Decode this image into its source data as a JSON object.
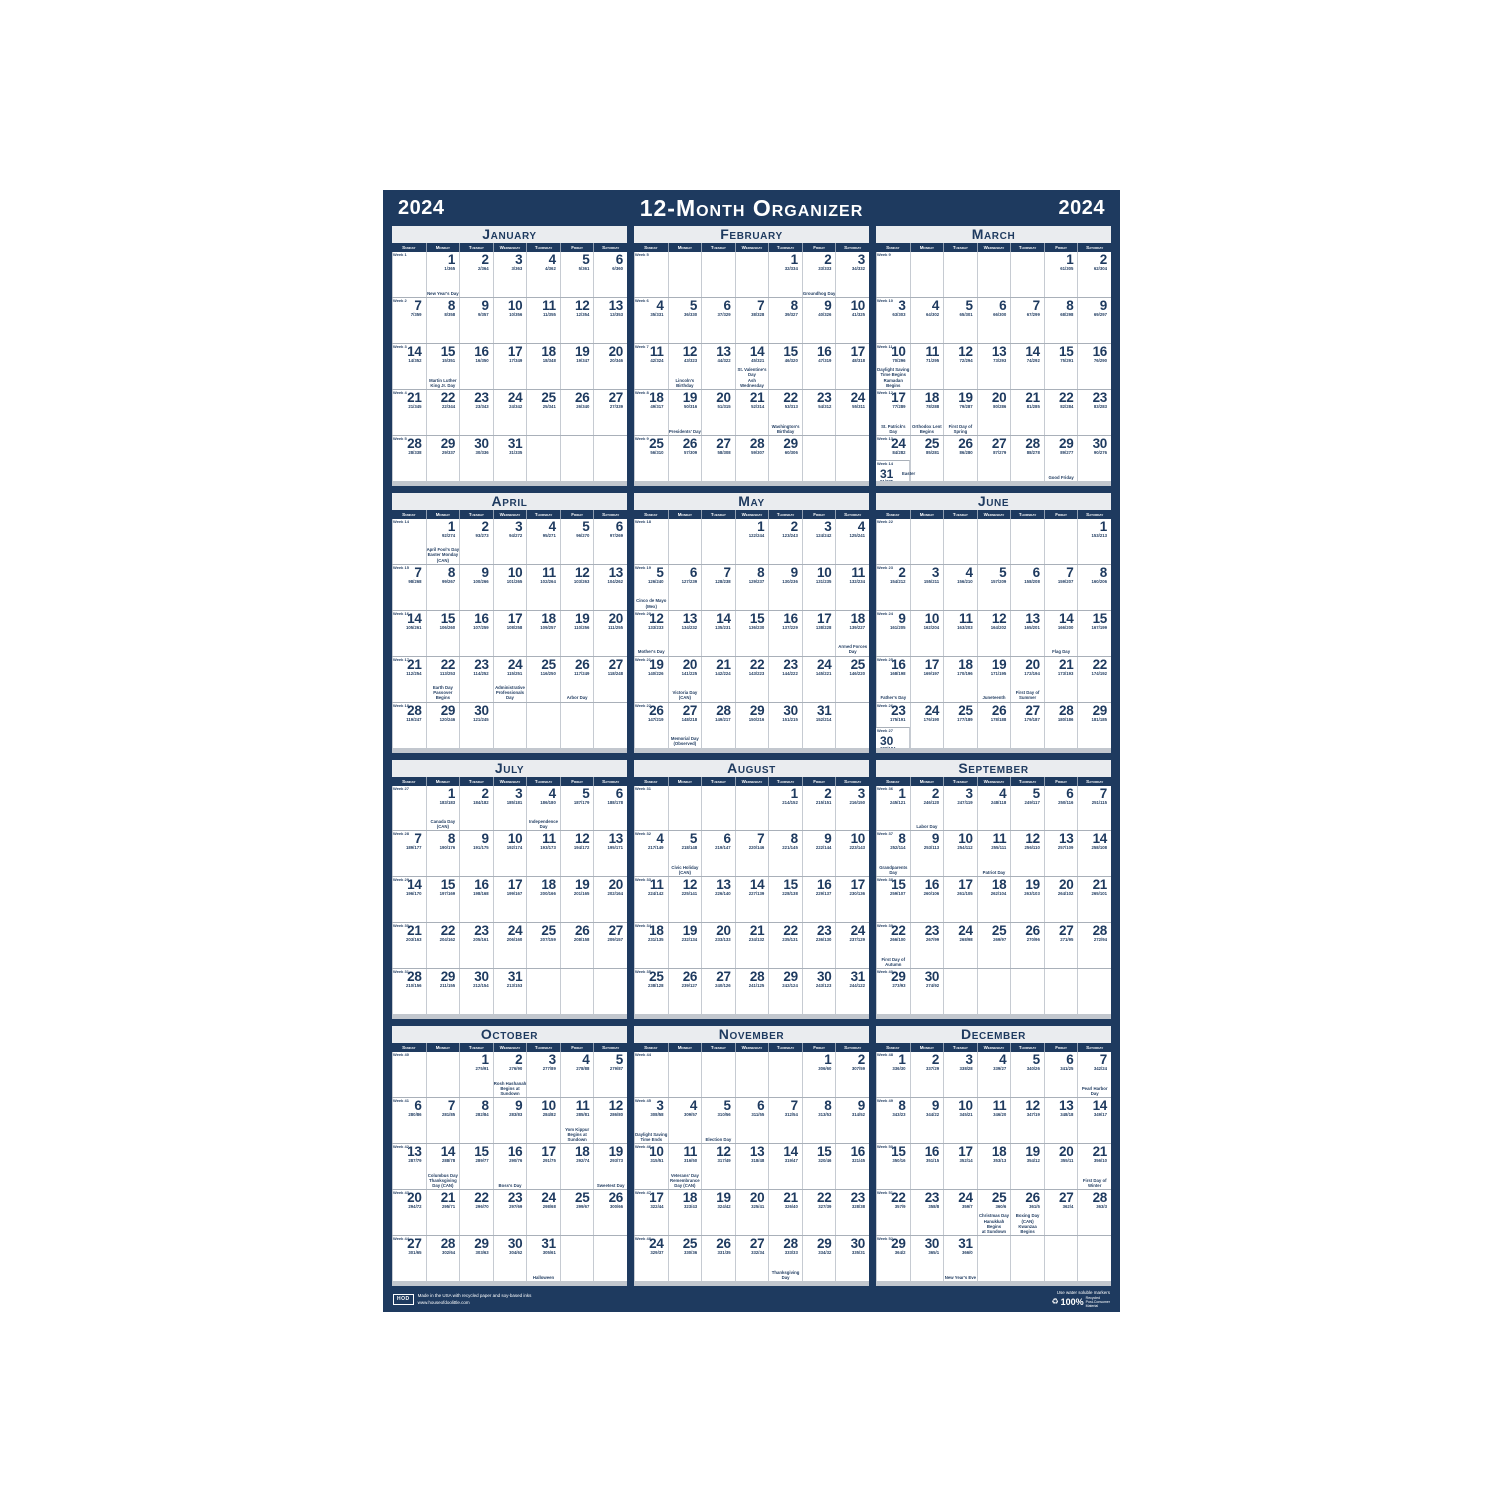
{
  "header": {
    "year_left": "2024",
    "title": "12-Month Organizer",
    "year_right": "2024"
  },
  "colors": {
    "navy": "#1e3a5f",
    "title_band": "#eaecef",
    "grid_line": "#c6cbd2",
    "page_bg": "#ffffff"
  },
  "week_label_prefix": "Week",
  "year_days": 366,
  "day_headers": [
    "Sunday",
    "Monday",
    "Tuesday",
    "Wednesday",
    "Thursday",
    "Friday",
    "Saturday"
  ],
  "months": [
    {
      "name": "January",
      "start_dow": 1,
      "num_days": 31,
      "start_week": 1,
      "start_doy": 1,
      "holidays": {
        "1": "New Year's Day",
        "15": "Martin Luther King Jr. Day"
      }
    },
    {
      "name": "February",
      "start_dow": 4,
      "num_days": 29,
      "start_week": 5,
      "start_doy": 32,
      "holidays": {
        "2": "Groundhog Day",
        "12": "Lincoln's Birthday",
        "14": "St. Valentine's Day|Ash Wednesday",
        "19": "Presidents' Day",
        "22": "Washington's Birthday"
      }
    },
    {
      "name": "March",
      "start_dow": 5,
      "num_days": 31,
      "start_week": 9,
      "start_doy": 61,
      "holidays": {
        "10": "Daylight Saving Time Begins|Ramadan Begins",
        "17": "St. Patrick's Day",
        "18": "Orthodox Lent Begins",
        "19": "First Day of Spring",
        "24": "Palm Sunday",
        "29": "Good Friday",
        "31": "Easter"
      }
    },
    {
      "name": "April",
      "start_dow": 1,
      "num_days": 30,
      "start_week": 14,
      "start_doy": 92,
      "holidays": {
        "1": "April Fool's Day|Easter Monday (CAN)",
        "22": "Earth Day|Passover Begins",
        "24": "Administrative|Professionals Day",
        "26": "Arbor Day"
      }
    },
    {
      "name": "May",
      "start_dow": 3,
      "num_days": 31,
      "start_week": 18,
      "start_doy": 122,
      "holidays": {
        "5": "Cinco de Mayo (Mex)",
        "12": "Mother's Day",
        "18": "Armed Forces Day",
        "20": "Victoria Day (CAN)",
        "27": "Memorial Day (Observed)"
      }
    },
    {
      "name": "June",
      "start_dow": 6,
      "num_days": 30,
      "start_week": 22,
      "start_doy": 153,
      "holidays": {
        "14": "Flag Day",
        "16": "Father's Day",
        "19": "Juneteenth",
        "20": "First Day of Summer"
      }
    },
    {
      "name": "July",
      "start_dow": 1,
      "num_days": 31,
      "start_week": 27,
      "start_doy": 183,
      "holidays": {
        "1": "Canada Day (CAN)",
        "4": "Independence Day"
      }
    },
    {
      "name": "August",
      "start_dow": 4,
      "num_days": 31,
      "start_week": 31,
      "start_doy": 214,
      "holidays": {
        "5": "Civic Holiday (CAN)"
      }
    },
    {
      "name": "September",
      "start_dow": 0,
      "num_days": 30,
      "start_week": 36,
      "start_doy": 245,
      "holidays": {
        "2": "Labor Day",
        "8": "Grandparents Day",
        "11": "Patriot Day",
        "22": "First Day of Autumn"
      }
    },
    {
      "name": "October",
      "start_dow": 2,
      "num_days": 31,
      "start_week": 40,
      "start_doy": 275,
      "holidays": {
        "2": "Rosh Hashanah|Begins at Sundown",
        "11": "Yom Kippur|Begins at Sundown",
        "14": "Columbus Day|Thanksgiving Day (CAN)",
        "16": "Boss's Day",
        "19": "Sweetest Day",
        "31": "Halloween"
      }
    },
    {
      "name": "November",
      "start_dow": 5,
      "num_days": 30,
      "start_week": 44,
      "start_doy": 306,
      "holidays": {
        "3": "Daylight Saving Time Ends",
        "5": "Election Day",
        "11": "Veterans' Day|Remembrance Day (CAN)",
        "28": "Thanksgiving Day"
      }
    },
    {
      "name": "December",
      "start_dow": 0,
      "num_days": 31,
      "start_week": 48,
      "start_doy": 336,
      "holidays": {
        "7": "Pearl Harbor Day",
        "21": "First Day of Winter",
        "25": "Christmas Day|Hanukkah Begins|at Sundown",
        "26": "Boxing Day (CAN)|Kwanzaa Begins",
        "31": "New Year's Eve"
      }
    }
  ],
  "footer": {
    "brand": "HOD",
    "left_line1": "Made in the USA with recycled paper and soy-based inks",
    "left_line2": "www.houseofdoolittle.com",
    "right_note": "Use water soluble markers",
    "recycle_pct": "100%",
    "recycle_line1": "Recycled",
    "recycle_line2": "Post-Consumer",
    "recycle_line3": "Material"
  }
}
